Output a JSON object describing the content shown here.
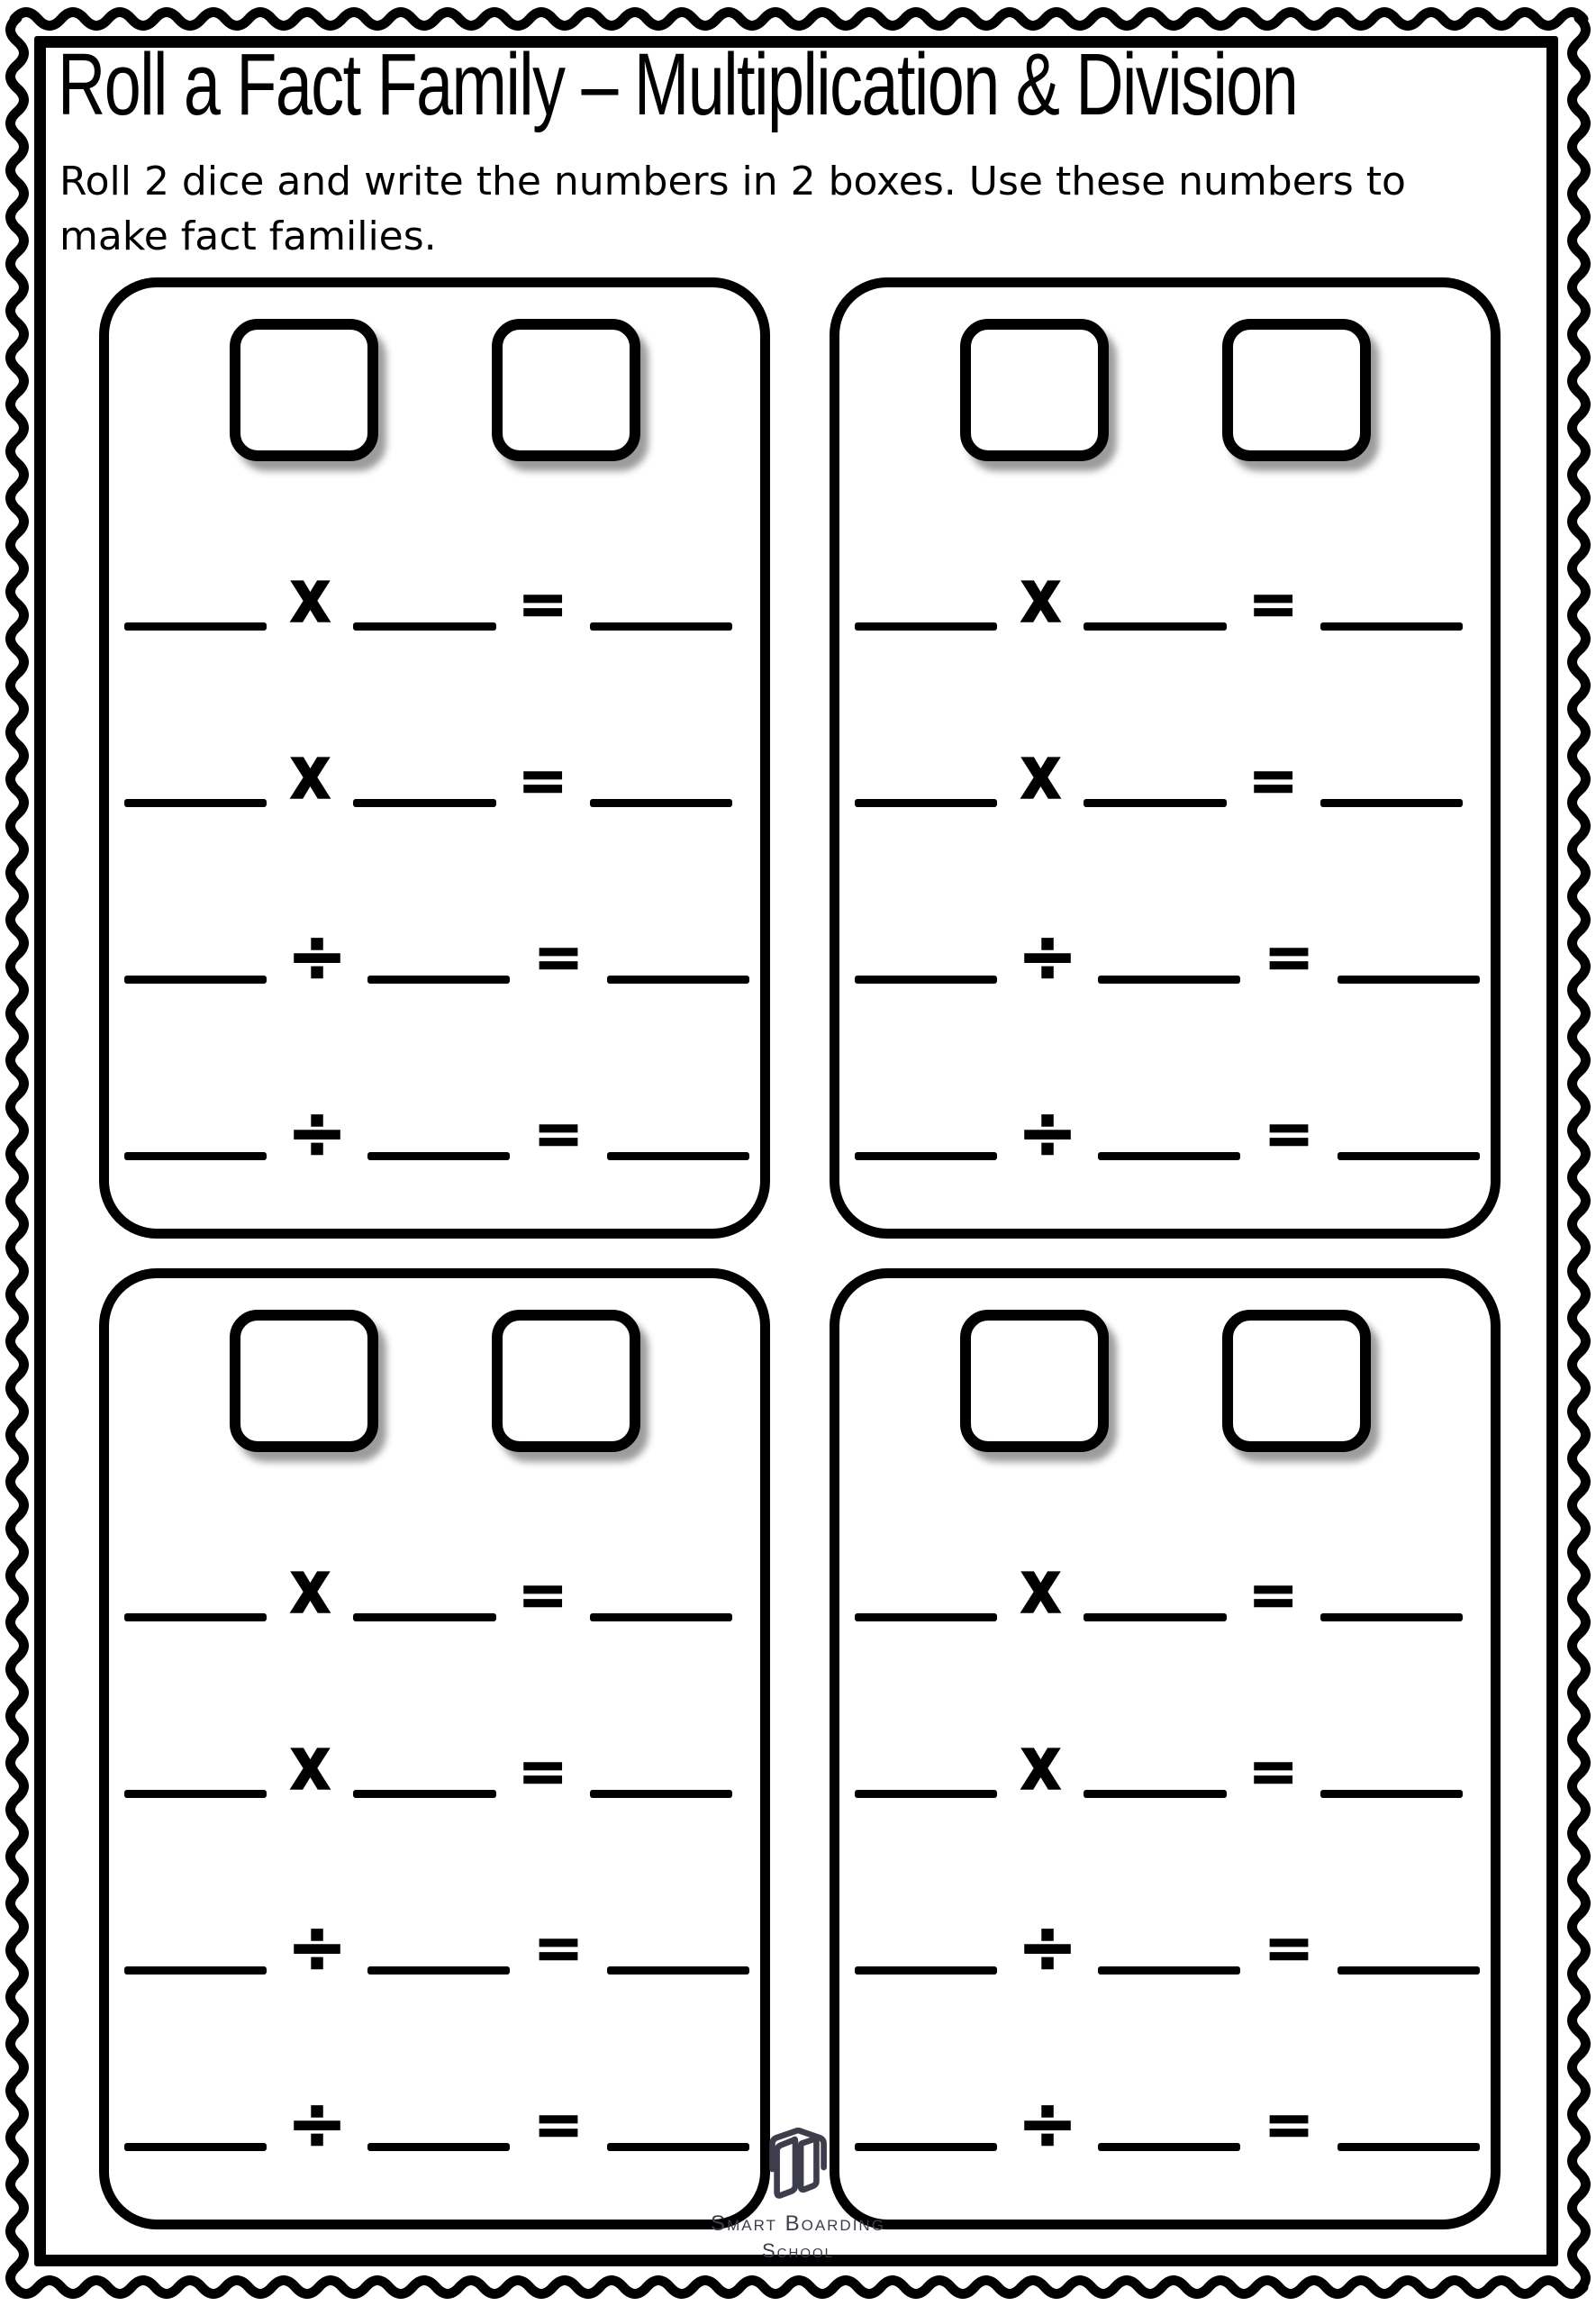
{
  "header": {
    "title": "Roll a Fact Family – Multiplication & Division",
    "instructions_line1": "Roll 2 dice and write the numbers in 2 boxes. Use these numbers to",
    "instructions_line2": "make fact families."
  },
  "operators": {
    "multiply": "x",
    "divide": "÷",
    "equals": "="
  },
  "worksheet": {
    "panel_count": 4,
    "dice_boxes_per_panel": 2,
    "rows_per_panel": [
      "multiply",
      "multiply",
      "divide",
      "divide"
    ]
  },
  "footer": {
    "logo_line1": "Smart Boarding",
    "logo_line2": "School"
  },
  "colors": {
    "ink": "#000000",
    "paper": "#ffffff",
    "logo": "#3d3d4b"
  }
}
